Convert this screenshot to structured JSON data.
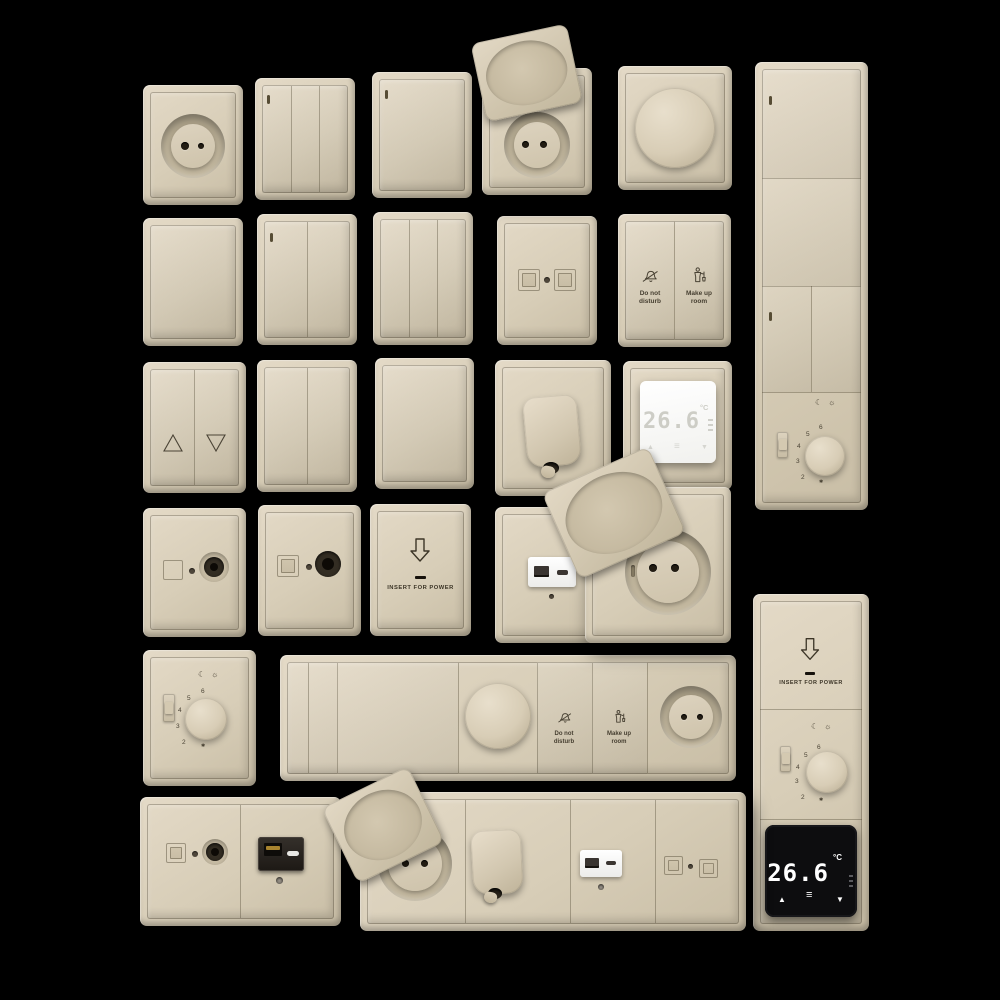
{
  "scene": {
    "background": "#000000",
    "plate_color": "#d8ceb9",
    "plate_edge_color": "#b5aa92",
    "engraving_color": "#4a4335",
    "display_white_bg": "#fbfbfa",
    "display_white_digits": "#cdcdc6",
    "display_black_bg": "#0d0d0f",
    "display_black_digits": "#ffffff",
    "usb_module_black": "#2a2520",
    "usb_gold": "#a8842f"
  },
  "hotel": {
    "do_not_disturb": {
      "line1": "Do not",
      "line2": "disturb"
    },
    "make_up_room": {
      "line1": "Make up",
      "line2": "room"
    }
  },
  "keycard": {
    "label": "INSERT FOR POWER"
  },
  "dial": {
    "numbers": [
      "2",
      "3",
      "4",
      "5",
      "6"
    ],
    "night_icon": "☾",
    "day_icon": "☼",
    "frost_icon": "✱"
  },
  "thermostat_white": {
    "temperature": "26.6",
    "unit": "°C",
    "up_icon": "▲",
    "down_icon": "▼",
    "menu_icon": "≡"
  },
  "thermostat_black": {
    "temperature": "26.6",
    "unit": "°C",
    "up_icon": "▲",
    "down_icon": "▼",
    "menu_icon": "≡"
  }
}
